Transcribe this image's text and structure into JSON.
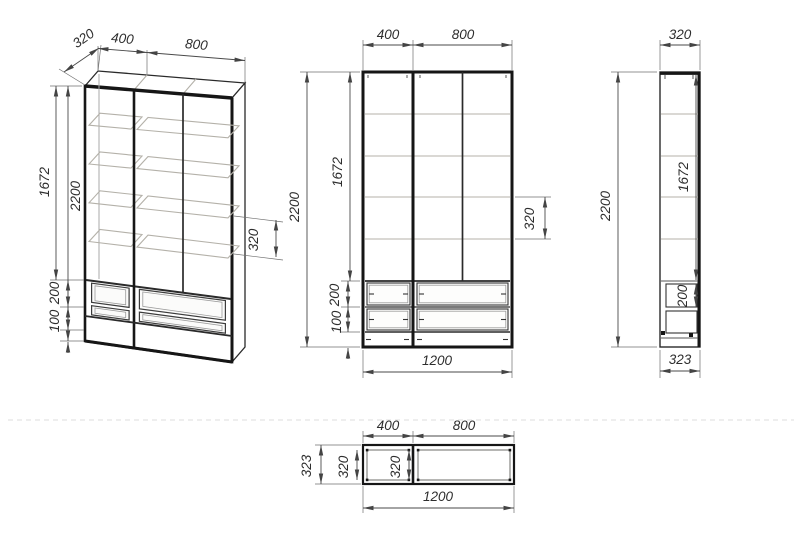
{
  "drawing_title": "wardrobe-technical-drawing",
  "colors": {
    "line": "#161616",
    "dimension": "#4a4a4a",
    "shelf": "#b4b1a9",
    "background": "#ffffff"
  },
  "iso": {
    "depth": "320",
    "width_left": "400",
    "width_right": "800",
    "shelf_height": "1672",
    "total_height": "2200",
    "shelf_gap": "320",
    "drawer_height": "200",
    "drawer2_height": "100"
  },
  "front": {
    "width_left": "400",
    "width_right": "800",
    "total_height": "2200",
    "shelf_height": "1672",
    "shelf_gap": "320",
    "drawer_height": "200",
    "drawer2_height": "100",
    "total_width": "1200"
  },
  "side": {
    "depth": "320",
    "total_height": "2200",
    "shelf_height": "1672",
    "drawer_height": "200",
    "total_depth": "323"
  },
  "top": {
    "width_left": "400",
    "width_right": "800",
    "total_depth": "323",
    "inner_depth_left": "320",
    "inner_depth_right": "320",
    "total_width": "1200"
  }
}
